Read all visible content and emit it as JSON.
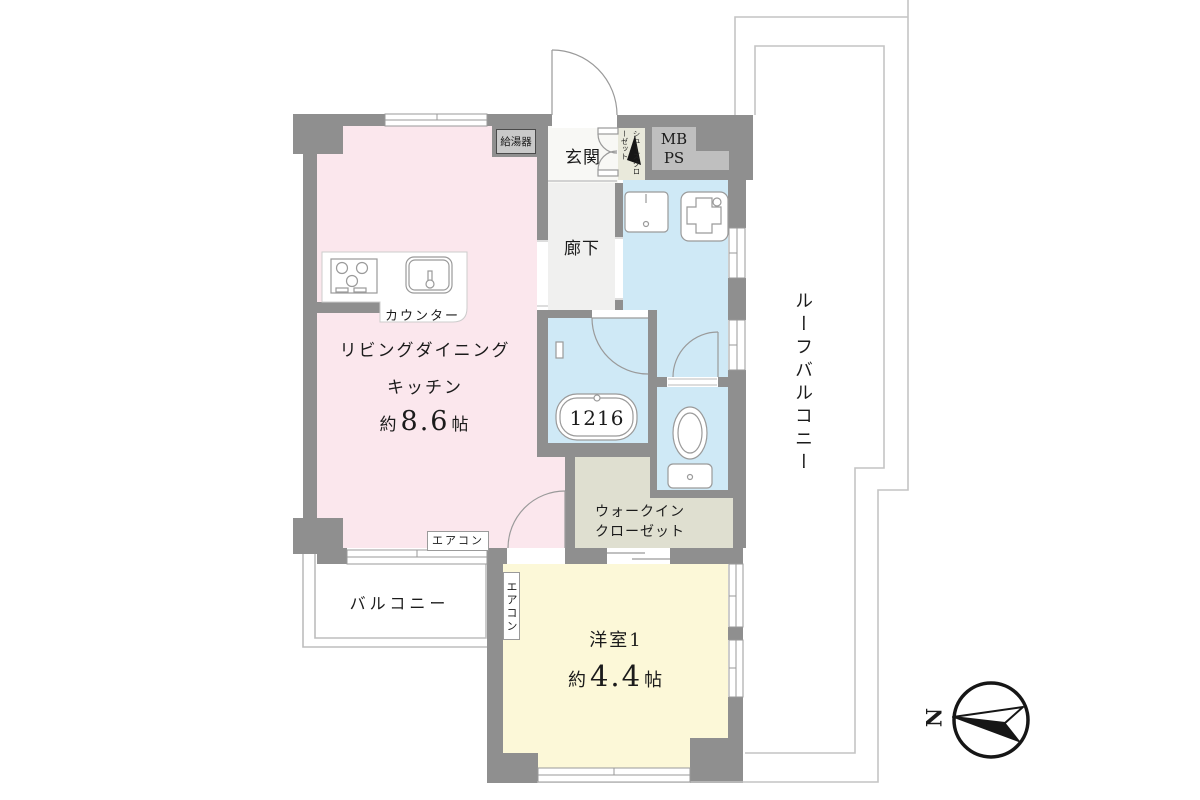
{
  "rooms": {
    "ldk": {
      "name_line1": "リビングダイニング",
      "name_line2": "キッチン",
      "area_prefix": "約",
      "area_value": "8.6",
      "area_unit": "帖",
      "color": "#fbe7ed"
    },
    "western_room": {
      "name": "洋室1",
      "area_prefix": "約",
      "area_value": "4.4",
      "area_unit": "帖",
      "color": "#fcf8d8"
    },
    "hallway": {
      "name": "廊下"
    },
    "entrance": {
      "name": "玄関"
    },
    "shoe_closet": {
      "name": "シューズクローゼット"
    },
    "walk_in_closet": {
      "name_line1": "ウォークイン",
      "name_line2": "クローゼット",
      "color": "#dfdfd0"
    },
    "bathroom": {
      "tub_size": "1216",
      "color": "#cfe9f6"
    },
    "balcony": {
      "name": "バルコニー"
    },
    "roof_balcony": {
      "name": "ルーフバルコニー"
    }
  },
  "equipment": {
    "water_heater": "給湯器",
    "meter_box": "MB",
    "pipe_space": "PS",
    "counter": "カウンター",
    "aircon_ldk": "エアコン",
    "aircon_western": "エアコン"
  },
  "compass": {
    "north": "N"
  },
  "colors": {
    "wall": "#8f8f8f",
    "ldk_pink": "#fbe7ed",
    "western_yellow": "#fcf8d8",
    "wet_blue": "#cfe9f6",
    "closet_beige": "#dfdfd0",
    "line_gray": "#c4c4c4"
  }
}
